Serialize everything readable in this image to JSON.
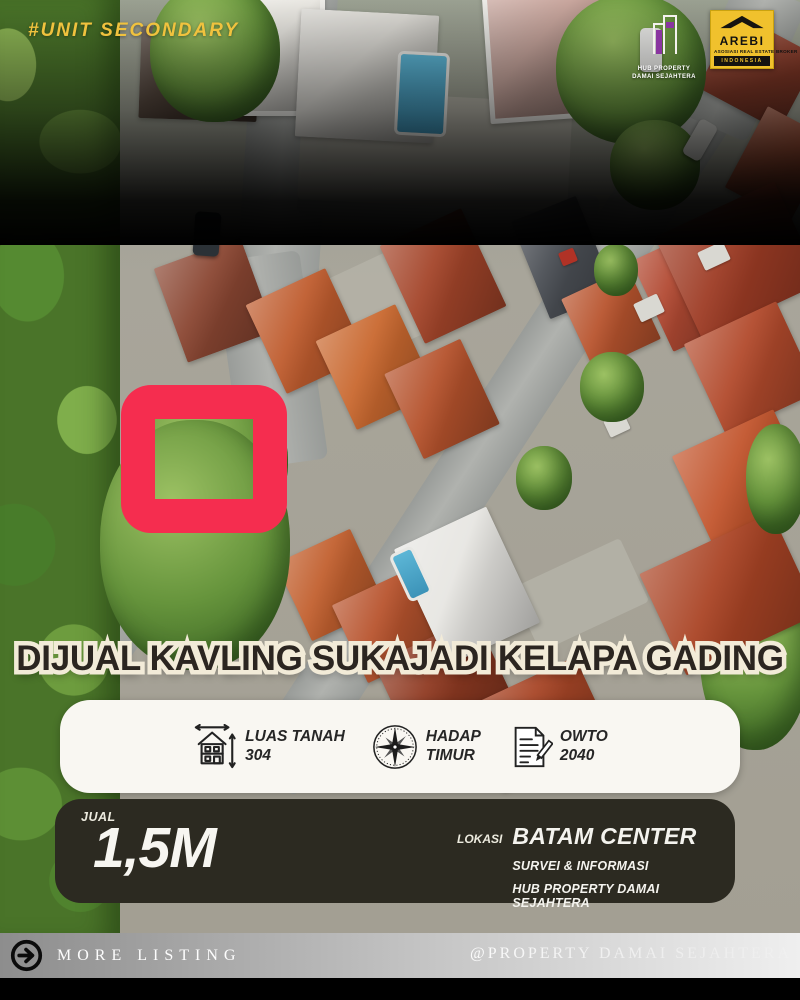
{
  "badge": {
    "text": "#UNIT SECONDARY"
  },
  "logos": {
    "property": {
      "line1": "HUB PROPERTY",
      "line2": "DAMAI SEJAHTERA"
    },
    "arebi": {
      "name": "AREBI",
      "sub": "ASOSIASI REAL ESTATE BROKER",
      "bar": "INDONESIA"
    }
  },
  "title": "DIJUAL KAVLING SUKAJADI KELAPA GADING",
  "specs": {
    "items": [
      {
        "icon": "house-measure-icon",
        "line1": "LUAS TANAH",
        "line2": "304"
      },
      {
        "icon": "compass-icon",
        "line1": "HADAP",
        "line2": "TIMUR"
      },
      {
        "icon": "document-pencil-icon",
        "line1": "OWTO",
        "line2": "2040"
      }
    ]
  },
  "price": {
    "label": "JUAL",
    "value": "1,5M"
  },
  "location": {
    "label": "LOKASI",
    "value": "BATAM CENTER",
    "note1": "SURVEI & INFORMASI",
    "note2": "HUB PROPERTY DAMAI SEJAHTERA"
  },
  "footer": {
    "more_label": "MORE LISTING",
    "handle": "@PROPERTY DAMAI SEJAHTERA"
  },
  "colors": {
    "accent_red": "#f52d4f",
    "badge_yellow": "#f0c23e",
    "title_fill": "#2b2520",
    "title_outline": "#f2ebd8",
    "info_card_bg": "#f9f7f2",
    "price_card_bg": "#2c2a21",
    "arebi_yellow": "#f0c12d",
    "logo_purple": "#8a35a0",
    "footer_gradient_left": "#8d8d8d",
    "footer_gradient_right": "#efefef"
  }
}
